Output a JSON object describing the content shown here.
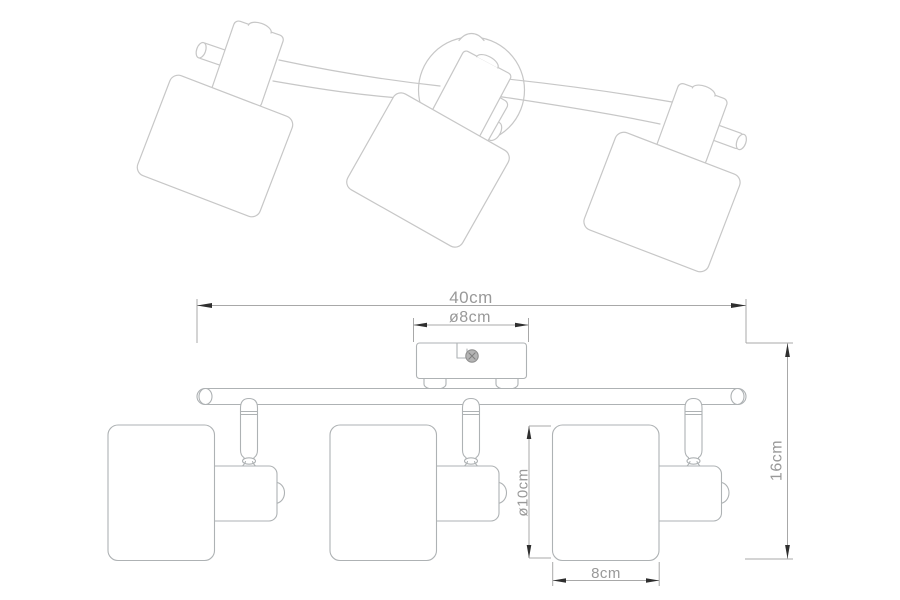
{
  "drawing": {
    "type": "product technical drawing",
    "subject": "three-spot ceiling track light, perspective view above and front elevation with dimensions below"
  },
  "dimensions": {
    "overall_width": "40cm",
    "canopy_diameter": "ø8cm",
    "overall_height": "16cm",
    "shade_diameter": "ø10cm",
    "shade_width": "8cm"
  },
  "colors": {
    "background": "#ffffff",
    "perspective_line": "#c7c7c7",
    "elevation_line": "#aeb2b4",
    "dimension_line": "#a8a8a8",
    "dimension_text": "#999999",
    "arrow": "#2f2f2f",
    "screw_fill": "#b4b4b4",
    "screw_stroke": "#8f8f8f"
  }
}
